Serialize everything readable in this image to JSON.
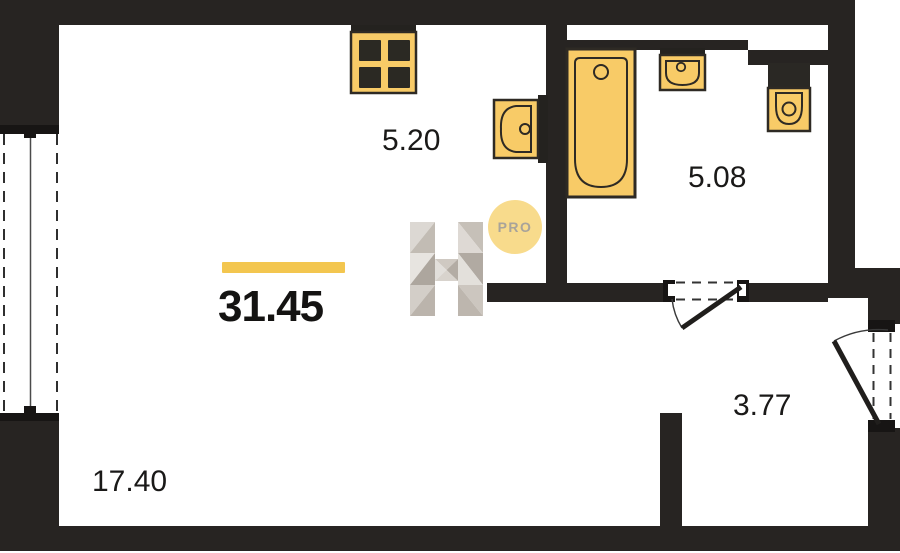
{
  "plan": {
    "total_area_label": "31.45",
    "badge_label": "PRO",
    "rooms": [
      {
        "name": "kitchen",
        "area_label": "5.20"
      },
      {
        "name": "bathroom",
        "area_label": "5.08"
      },
      {
        "name": "hallway",
        "area_label": "3.77"
      },
      {
        "name": "living-room",
        "area_label": "17.40"
      }
    ],
    "icons": [
      "stove-icon",
      "kitchen-sink-icon",
      "bathtub-icon",
      "washbasin-icon",
      "toilet-icon",
      "h-logo-watermark",
      "pro-badge"
    ],
    "colors": {
      "accent_yellow": "#F3C64F",
      "fixture_yellow": "#F8CB67",
      "wall_black": "#272422",
      "label_text": "#1A1918",
      "badge_fill": "#F8DB8C",
      "badge_text": "#A8A39A"
    }
  }
}
